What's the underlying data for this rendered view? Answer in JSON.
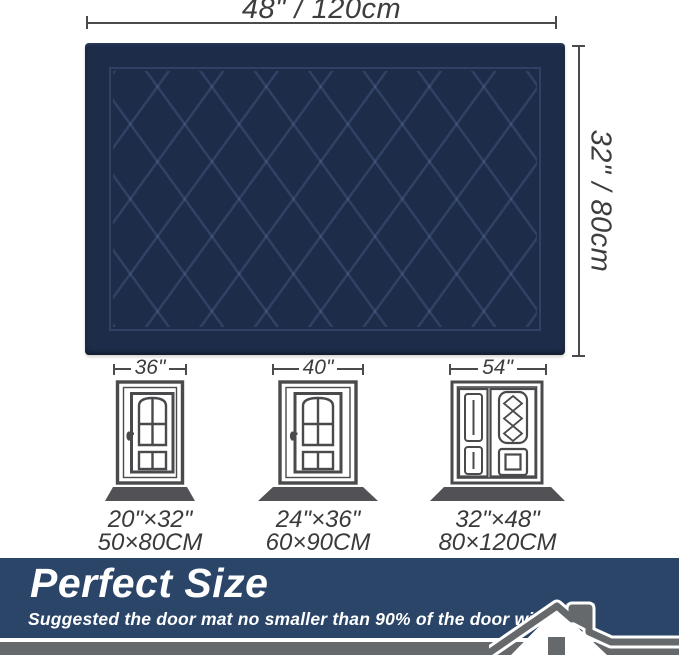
{
  "mat": {
    "width_label": "48\" / 120cm",
    "height_label": "32\" / 80cm"
  },
  "doors": [
    {
      "type": "single",
      "door_width": "36\"",
      "mat_inches": "20\"×32\"",
      "mat_cm": "50×80CM"
    },
    {
      "type": "single",
      "door_width": "40\"",
      "mat_inches": "24\"×36\"",
      "mat_cm": "60×90CM"
    },
    {
      "type": "double",
      "door_width": "54\"",
      "mat_inches": "32\"×48\"",
      "mat_cm": "80×120CM"
    }
  ],
  "banner": {
    "title": "Perfect Size",
    "subtitle": "Suggested the door mat no smaller than 90% of the door width."
  },
  "colors": {
    "mat_navy": "#1d2c49",
    "mat_pattern_line": "#3a4c73",
    "banner_navy": "#2a4568",
    "footer_gray": "#66696b",
    "dimension_text": "#3d3d3d",
    "door_outline": "#4a4a4c",
    "door_mat_gray": "#525256"
  },
  "icons": {
    "house": "house-icon",
    "single_door": "single-door-icon",
    "double_door": "double-door-icon"
  }
}
